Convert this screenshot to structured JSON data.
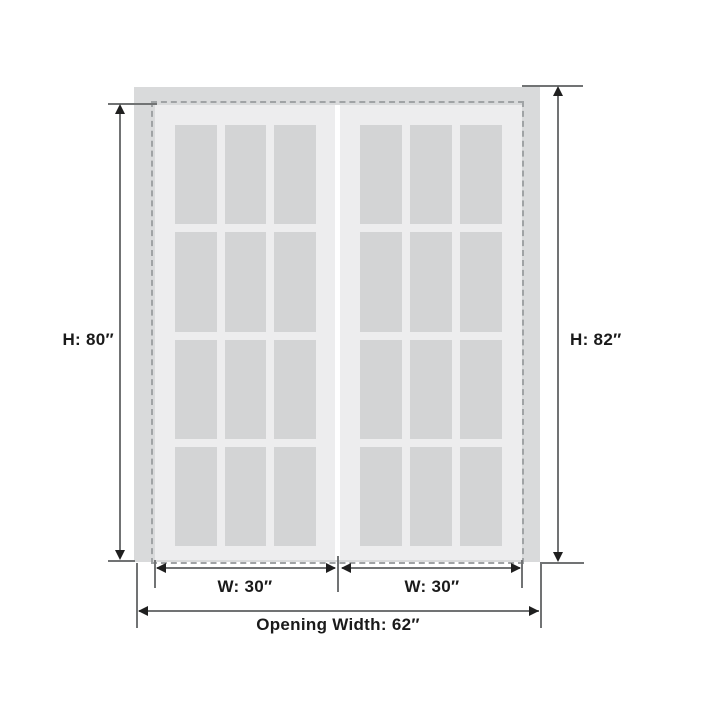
{
  "diagram_title": "double-door-dimension-diagram",
  "labels": {
    "door_height": "H: 80″",
    "opening_height": "H: 82″",
    "left_door_width": "W: 30″",
    "right_door_width": "W: 30″",
    "opening_width": "Opening Width: 62″"
  },
  "doors": {
    "count": 2,
    "lite_columns": 3,
    "lite_rows": 4
  },
  "colors": {
    "frame": "#d9dadb",
    "door_slab": "#ededee",
    "glass_lite": "#d3d4d5",
    "dashed_outline": "#a0a3a5",
    "dimension_line": "#717374",
    "arrowhead": "#1f1f1f",
    "text": "#1a1a1a",
    "background": "#ffffff"
  }
}
